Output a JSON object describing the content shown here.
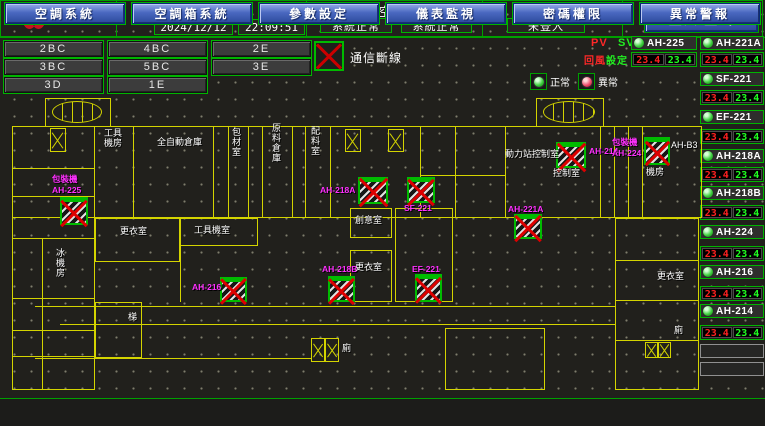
{
  "header": {
    "logo": {
      "title": "宏亞食品",
      "subtitle": "HUNYA FOODS"
    },
    "system_time": {
      "label": "系統時間",
      "date": "2024/12/12",
      "time": "22:09:51"
    },
    "machine_status": {
      "label": "冰機 / 空調機 狀態",
      "chiller": "系統正常",
      "ahu": "系統正常"
    },
    "login": {
      "label": "登入人員",
      "status": "未登入",
      "button": "登入/登出"
    }
  },
  "floor_buttons": [
    {
      "label": "2BC"
    },
    {
      "label": "4BC"
    },
    {
      "label": "2E"
    },
    {
      "label": "3BC"
    },
    {
      "label": "5BC"
    },
    {
      "label": "3E"
    },
    {
      "label": "3D"
    },
    {
      "label": "1E"
    }
  ],
  "comm_alarm": {
    "label": "通信斷線"
  },
  "legend": {
    "normal": "正常",
    "abnormal": "異常"
  },
  "readout_header": {
    "pv": "PV",
    "sv": "SV",
    "pv_desc": "回風",
    "sv_desc": "設定"
  },
  "equipment": {
    "col_a": [
      {
        "name": "AH-225",
        "pv": "23.4",
        "sv": "23.4"
      }
    ],
    "col_b": [
      {
        "name": "AH-221A",
        "pv": "23.4",
        "sv": "23.4"
      },
      {
        "name": "SF-221",
        "pv": "23.4",
        "sv": "23.4"
      },
      {
        "name": "EF-221",
        "pv": "23.4",
        "sv": "23.4"
      },
      {
        "name": "AH-218A",
        "pv": "23.4",
        "sv": "23.4"
      },
      {
        "name": "AH-218B",
        "pv": "23.4",
        "sv": "23.4"
      },
      {
        "name": "AH-224",
        "pv": "23.4",
        "sv": "23.4"
      },
      {
        "name": "AH-216",
        "pv": "23.4",
        "sv": "23.4"
      },
      {
        "name": "AH-214",
        "pv": "23.4",
        "sv": "23.4"
      }
    ]
  },
  "floorplan": {
    "rooms": [
      {
        "label": "工具機房"
      },
      {
        "label": "全自動倉庫"
      },
      {
        "label": "包材室"
      },
      {
        "label": "原料倉庫"
      },
      {
        "label": "配料室"
      },
      {
        "label": "AH-B3"
      },
      {
        "label": "動力站控制室"
      },
      {
        "label": "控制室"
      },
      {
        "label": "機房"
      },
      {
        "label": "更衣室"
      },
      {
        "label": "工具機室"
      },
      {
        "label": "創意室"
      },
      {
        "label": "更衣室"
      },
      {
        "label": "冰機房"
      },
      {
        "label": "梯"
      },
      {
        "label": "廁"
      },
      {
        "label": "更衣室"
      },
      {
        "label": "廁"
      }
    ],
    "units": [
      {
        "name": "AH-225",
        "lines": [
          "包裝機",
          "AH-225"
        ]
      },
      {
        "name": "AH-218A",
        "lines": [
          "AH-218A"
        ]
      },
      {
        "name": "SF-221",
        "lines": [
          "SF-221"
        ]
      },
      {
        "name": "AH-214",
        "lines": [
          "AH-214"
        ]
      },
      {
        "name": "AH-224",
        "lines": [
          "包裝機",
          "AH-224"
        ]
      },
      {
        "name": "AH-221A",
        "lines": [
          "AH-221A"
        ]
      },
      {
        "name": "AH-216",
        "lines": [
          "AH-216"
        ]
      },
      {
        "name": "AH-218B",
        "lines": [
          "AH-218B"
        ]
      },
      {
        "name": "EF-221",
        "lines": [
          "EF-221"
        ]
      }
    ]
  },
  "nav_buttons": [
    {
      "label": "空調系統"
    },
    {
      "label": "空調箱系統"
    },
    {
      "label": "參數設定"
    },
    {
      "label": "儀表監視"
    },
    {
      "label": "密碼權限"
    },
    {
      "label": "異常警報"
    }
  ]
}
